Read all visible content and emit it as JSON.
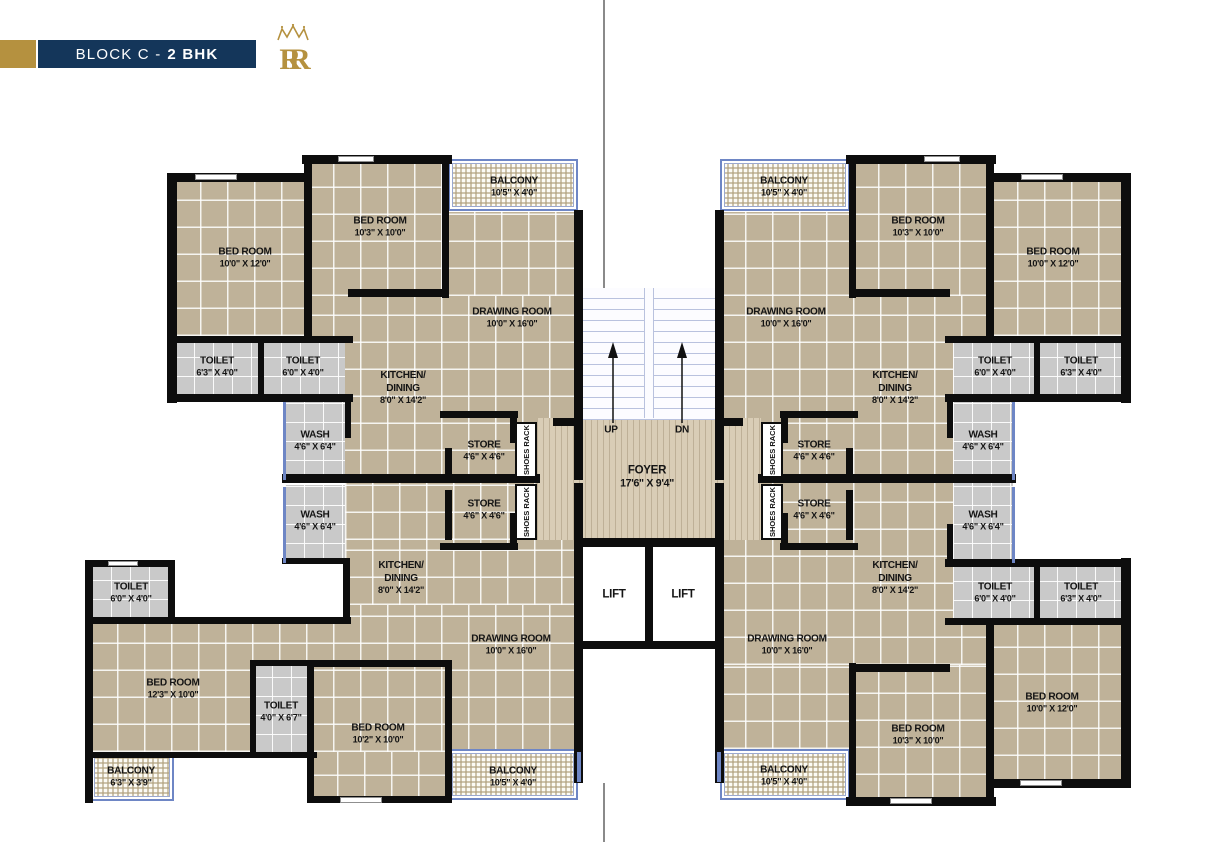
{
  "header": {
    "title_prefix": "BLOCK C -",
    "title_bold": "2 BHK",
    "logo_text": "RR"
  },
  "colors": {
    "accent_gold": "#b5913f",
    "banner_navy": "#14365a",
    "floor_tan": "#bfb299",
    "wet_area_gray": "#c9c9c9",
    "foyer_beige": "#d9cdb6",
    "wall_black": "#0d0d0d",
    "window_blue": "#6e86c5"
  },
  "core": {
    "up": "UP",
    "dn": "DN",
    "foyer": {
      "name": "FOYER",
      "dims": "17'6\" X 9'4\""
    },
    "lift_left": "LIFT",
    "lift_right": "LIFT",
    "shoes_rack": "SHOES RACK"
  },
  "units": {
    "top_left": {
      "bedroom_main": {
        "name": "BED ROOM",
        "dims": "10'0\" X 12'0\""
      },
      "bedroom_second": {
        "name": "BED ROOM",
        "dims": "10'3\" X 10'0\""
      },
      "balcony": {
        "name": "BALCONY",
        "dims": "10'5\" X 4'0\""
      },
      "drawing": {
        "name": "DRAWING ROOM",
        "dims": "10'0\" X 16'0\""
      },
      "kitchen": {
        "name": "KITCHEN/",
        "name2": "DINING",
        "dims": "8'0\" X 14'2\""
      },
      "toilet_a": {
        "name": "TOILET",
        "dims": "6'3\" X 4'0\""
      },
      "toilet_b": {
        "name": "TOILET",
        "dims": "6'0\" X 4'0\""
      },
      "wash": {
        "name": "WASH",
        "dims": "4'6\" X 6'4\""
      },
      "store": {
        "name": "STORE",
        "dims": "4'6\" X 4'6\""
      }
    },
    "top_right": {
      "bedroom_main": {
        "name": "BED ROOM",
        "dims": "10'0\" X 12'0\""
      },
      "bedroom_second": {
        "name": "BED ROOM",
        "dims": "10'3\" X 10'0\""
      },
      "balcony": {
        "name": "BALCONY",
        "dims": "10'5\" X 4'0\""
      },
      "drawing": {
        "name": "DRAWING ROOM",
        "dims": "10'0\" X 16'0\""
      },
      "kitchen": {
        "name": "KITCHEN/",
        "name2": "DINING",
        "dims": "8'0\" X 14'2\""
      },
      "toilet_a": {
        "name": "TOILET",
        "dims": "6'0\" X 4'0\""
      },
      "toilet_b": {
        "name": "TOILET",
        "dims": "6'3\" X 4'0\""
      },
      "wash": {
        "name": "WASH",
        "dims": "4'6\" X 6'4\""
      },
      "store": {
        "name": "STORE",
        "dims": "4'6\" X 4'6\""
      }
    },
    "bottom_left": {
      "toilet_a": {
        "name": "TOILET",
        "dims": "6'0\" X 4'0\""
      },
      "kitchen": {
        "name": "KITCHEN/",
        "name2": "DINING",
        "dims": "8'0\" X 14'2\""
      },
      "store": {
        "name": "STORE",
        "dims": "4'6\" X 4'6\""
      },
      "wash": {
        "name": "WASH",
        "dims": "4'6\" X 6'4\""
      },
      "drawing": {
        "name": "DRAWING ROOM",
        "dims": "10'0\" X 16'0\""
      },
      "bedroom_main": {
        "name": "BED ROOM",
        "dims": "12'3\" X 10'0\""
      },
      "toilet_b": {
        "name": "TOILET",
        "dims": "4'0\" X 6'7\""
      },
      "bedroom_second": {
        "name": "BED ROOM",
        "dims": "10'2\" X 10'0\""
      },
      "balcony_small": {
        "name": "BALCONY",
        "dims": "6'3\" X 3'9\""
      },
      "balcony": {
        "name": "BALCONY",
        "dims": "10'5\" X 4'0\""
      }
    },
    "bottom_right": {
      "kitchen": {
        "name": "KITCHEN/",
        "name2": "DINING",
        "dims": "8'0\" X 14'2\""
      },
      "store": {
        "name": "STORE",
        "dims": "4'6\" X 4'6\""
      },
      "wash": {
        "name": "WASH",
        "dims": "4'6\" X 6'4\""
      },
      "toilet_a": {
        "name": "TOILET",
        "dims": "6'0\" X 4'0\""
      },
      "toilet_b": {
        "name": "TOILET",
        "dims": "6'3\" X 4'0\""
      },
      "drawing": {
        "name": "DRAWING ROOM",
        "dims": "10'0\" X 16'0\""
      },
      "bedroom_second": {
        "name": "BED ROOM",
        "dims": "10'3\" X 10'0\""
      },
      "bedroom_main": {
        "name": "BED ROOM",
        "dims": "10'0\" X 12'0\""
      },
      "balcony": {
        "name": "BALCONY",
        "dims": "10'5\" X 4'0\""
      }
    }
  }
}
